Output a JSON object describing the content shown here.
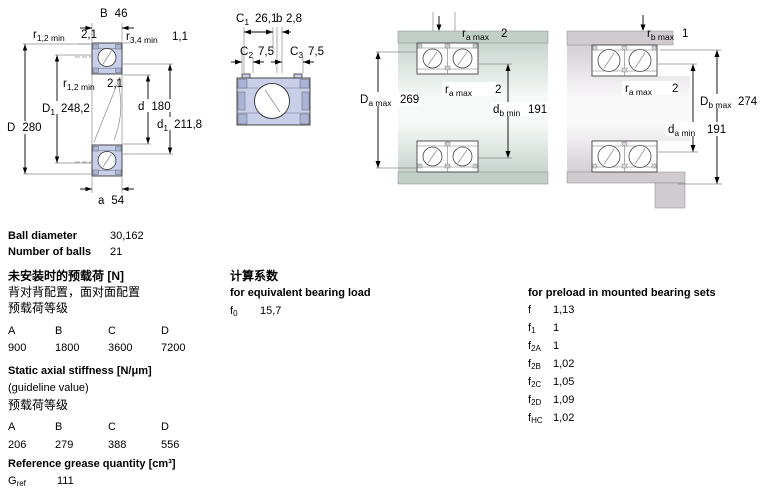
{
  "colors": {
    "bearing_fill": "#c9cfe9",
    "bearing_fill_dark": "#aab3d8",
    "housing_green": "#c2cec8",
    "housing_gray": "#cfcbcf"
  },
  "diagrams": {
    "d1": {
      "dims": {
        "B": {
          "sym": "B",
          "val": "46"
        },
        "r12_top": {
          "sym": "r",
          "sub": "1,2 min",
          "val": "2,1"
        },
        "r34": {
          "sym": "r",
          "sub": "3,4 min",
          "val": "1,1"
        },
        "r12_mid": {
          "sym": "r",
          "sub": "1,2 min",
          "val": "2,1"
        },
        "D1": {
          "sym": "D",
          "sub": "1",
          "val": "248,2"
        },
        "D": {
          "sym": "D",
          "val": "280"
        },
        "d": {
          "sym": "d",
          "val": "180"
        },
        "d1": {
          "sym": "d",
          "sub": "1",
          "val": "211,8"
        },
        "a": {
          "sym": "a",
          "val": "54"
        }
      }
    },
    "d2": {
      "dims": {
        "C1": {
          "sym": "C",
          "sub": "1",
          "val": "26,1"
        },
        "b": {
          "sym": "b",
          "val": "2,8"
        },
        "C2": {
          "sym": "C",
          "sub": "2",
          "val": "7,5"
        },
        "C3": {
          "sym": "C",
          "sub": "3",
          "val": "7,5"
        }
      }
    },
    "d3": {
      "dims": {
        "ra_top": {
          "sym": "r",
          "sub": "a max",
          "val": "2"
        },
        "ra_mid": {
          "sym": "r",
          "sub": "a max",
          "val": "2"
        },
        "Da": {
          "sym": "D",
          "sub": "a max",
          "val": "269"
        },
        "db": {
          "sym": "d",
          "sub": "b min",
          "val": "191"
        }
      }
    },
    "d4": {
      "dims": {
        "rb": {
          "sym": "r",
          "sub": "b max",
          "val": "1"
        },
        "ra": {
          "sym": "r",
          "sub": "a max",
          "val": "2"
        },
        "Db": {
          "sym": "D",
          "sub": "b max",
          "val": "274"
        },
        "da": {
          "sym": "d",
          "sub": "a min",
          "val": "191"
        }
      }
    }
  },
  "specs": {
    "ball_diameter_label": "Ball diameter",
    "ball_diameter_value": "30,162",
    "number_of_balls_label": "Number of balls",
    "number_of_balls_value": "21"
  },
  "preload_unmounted": {
    "title": "未安装时的预载荷 [N]",
    "subtitle": "背对背配置，面对面配置",
    "class_label": "预载荷等级",
    "headers": [
      "A",
      "B",
      "C",
      "D"
    ],
    "values": [
      "900",
      "1800",
      "3600",
      "7200"
    ]
  },
  "stiffness": {
    "title": "Static axial stiffness [N/μm]",
    "subtitle": "(guideline value)",
    "class_label": "预载荷等级",
    "headers": [
      "A",
      "B",
      "C",
      "D"
    ],
    "values": [
      "206",
      "279",
      "388",
      "556"
    ]
  },
  "grease": {
    "title": "Reference grease quantity [cm³]",
    "sym": "G",
    "sub": "ref",
    "val": "111"
  },
  "calc_factors": {
    "title": "计算系数",
    "subtitle": "for equivalent bearing load",
    "sym": "f",
    "sub": "0",
    "val": "15,7"
  },
  "preload_factors": {
    "title": "for preload in mounted bearing sets",
    "rows": [
      {
        "sym": "f",
        "sub": "",
        "val": "1,13"
      },
      {
        "sym": "f",
        "sub": "1",
        "val": "1"
      },
      {
        "sym": "f",
        "sub": "2A",
        "val": "1"
      },
      {
        "sym": "f",
        "sub": "2B",
        "val": "1,02"
      },
      {
        "sym": "f",
        "sub": "2C",
        "val": "1,05"
      },
      {
        "sym": "f",
        "sub": "2D",
        "val": "1,09"
      },
      {
        "sym": "f",
        "sub": "HC",
        "val": "1,02"
      }
    ]
  }
}
